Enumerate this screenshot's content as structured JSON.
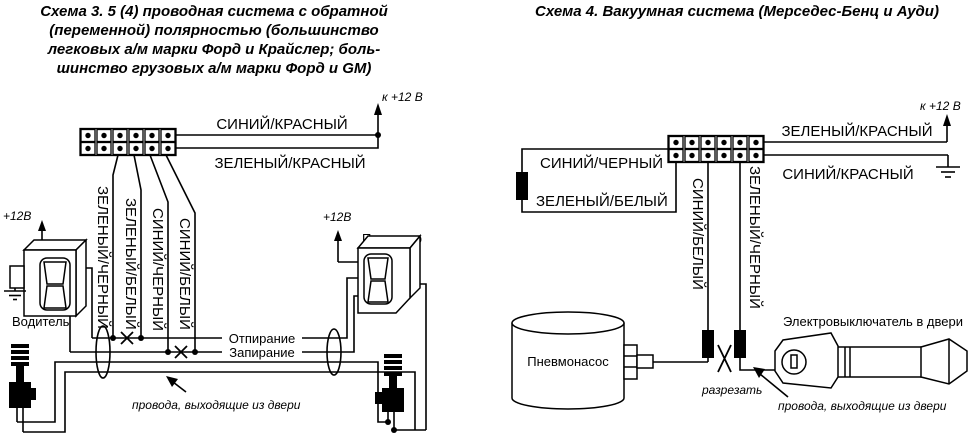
{
  "colors": {
    "ink": "#000000",
    "paper": "#ffffff"
  },
  "schema3": {
    "title_lines": [
      "Схема 3. 5 (4) проводная система с обратной",
      "(переменной) полярностью (большинство",
      "легковых а/м марки Форд и Крайслер; боль-",
      "шинство грузовых а/м марки Форд и GM)"
    ],
    "to_12v_label": "к +12 В",
    "wire_blue_red": "СИНИЙ/КРАСНЫЙ",
    "wire_green_red": "ЗЕЛЕНЫЙ/КРАСНЫЙ",
    "wire_green_black": "ЗЕЛЕНЫЙ/ЧЕРНЫЙ",
    "wire_green_white": "ЗЕЛЕНЫЙ/БЕЛЫЙ",
    "wire_blue_black": "СИНИЙ/ЧЕРНЫЙ",
    "wire_blue_white": "СИНИЙ/БЕЛЫЙ",
    "driver_12v_label": "+12В",
    "passenger_12v_label": "+12В",
    "driver_label": "Водитель",
    "passenger_label": "Пассажир",
    "unlock_label": "Отпирание",
    "lock_label": "Запирание",
    "door_wires_note": "провода, выходящие из двери"
  },
  "schema4": {
    "title": "Схема 4. Вакуумная система (Мерседес-Бенц и Ауди)",
    "to_12v_label": "к +12 В",
    "wire_green_red": "ЗЕЛЕНЫЙ/КРАСНЫЙ",
    "wire_blue_red": "СИНИЙ/КРАСНЫЙ",
    "wire_blue_black": "СИНИЙ/ЧЕРНЫЙ",
    "wire_green_white": "ЗЕЛЕНЫЙ/БЕЛЫЙ",
    "wire_blue_white": "СИНИЙ/БЕЛЫЙ",
    "wire_green_black": "ЗЕЛЕНЫЙ/ЧЕРНЫЙ",
    "pump_label": "Пневмонасос",
    "door_switch_label": "Электровыключатель в двери",
    "cut_label": "разрезать",
    "door_wires_note": "провода, выходящие из двери"
  },
  "icons": {
    "power_arrow": "up-arrow",
    "ground": "ground-symbol",
    "cut_mark": "x-cut",
    "door_grommet": "oval",
    "connector_pin": "dot"
  }
}
